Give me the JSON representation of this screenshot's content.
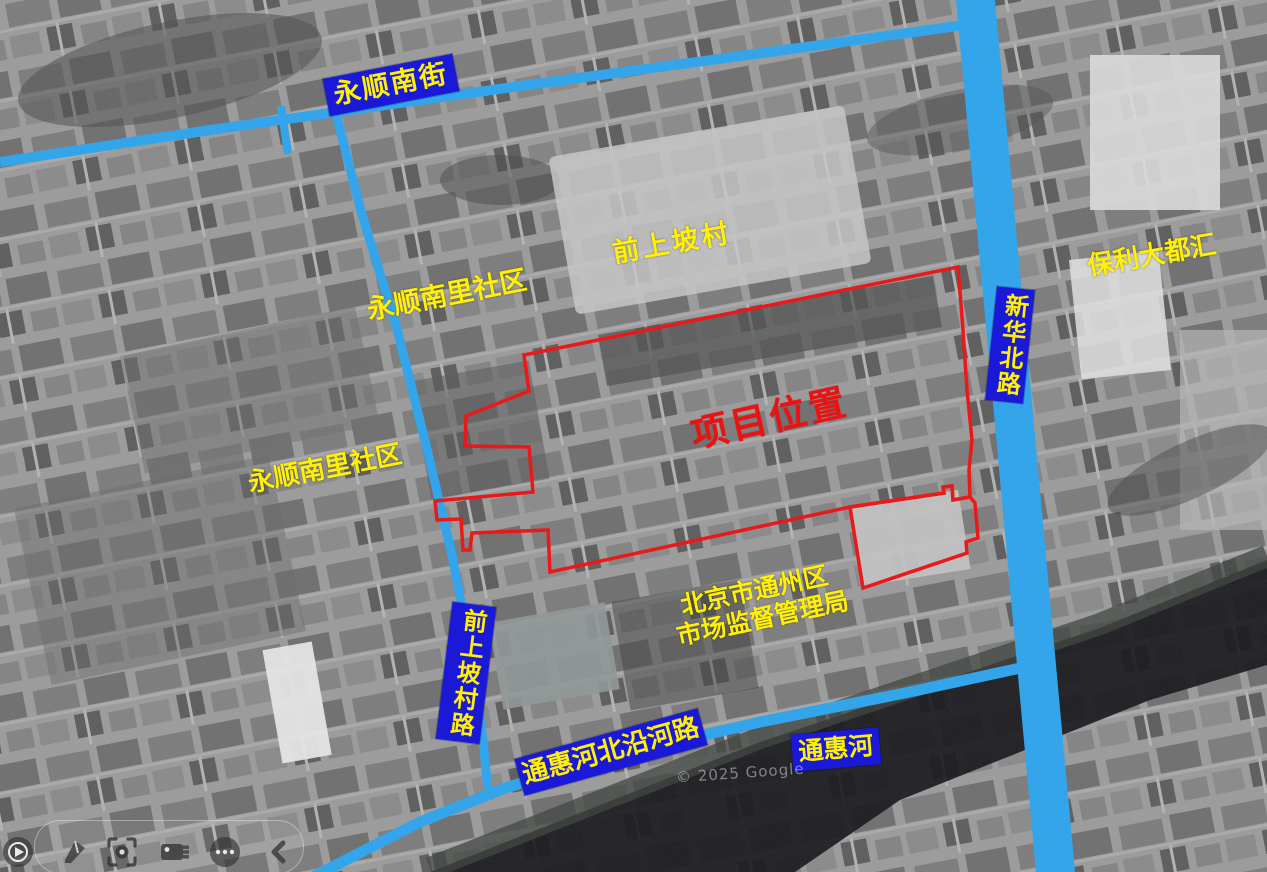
{
  "labels": {
    "yongshun_south_street": "永顺南街",
    "qianshangpo_village": "前上坡村",
    "yongshun_nanli_community_upper": "永顺南里社区",
    "yongshun_nanli_community_lower": "永顺南里社区",
    "poly_grand_plaza": "保利大都汇",
    "xinhua_north_road": "新华北路",
    "project_location": "项目位置",
    "qianshangpo_village_road": "前上坡村路",
    "market_supervision_bureau_line1": "北京市通州区",
    "market_supervision_bureau_line2": "市场监督管理局",
    "tonghui_riverside_road": "通惠河北沿河路",
    "tonghui_river": "通惠河"
  },
  "watermark": "© 2025 Google",
  "colors": {
    "road_highlight": "#2EA4EC",
    "label_box_blue": "#1B19D8",
    "label_text_yellow": "#FFF100",
    "project_boundary_red": "#EC1212"
  },
  "toolbar": {
    "icons": [
      {
        "name": "slideshow-play-icon"
      },
      {
        "name": "pen-icon"
      },
      {
        "name": "laser-viewfinder-icon"
      },
      {
        "name": "eraser-icon"
      },
      {
        "name": "more-options-icon"
      },
      {
        "name": "collapse-toolbar-icon"
      }
    ]
  }
}
